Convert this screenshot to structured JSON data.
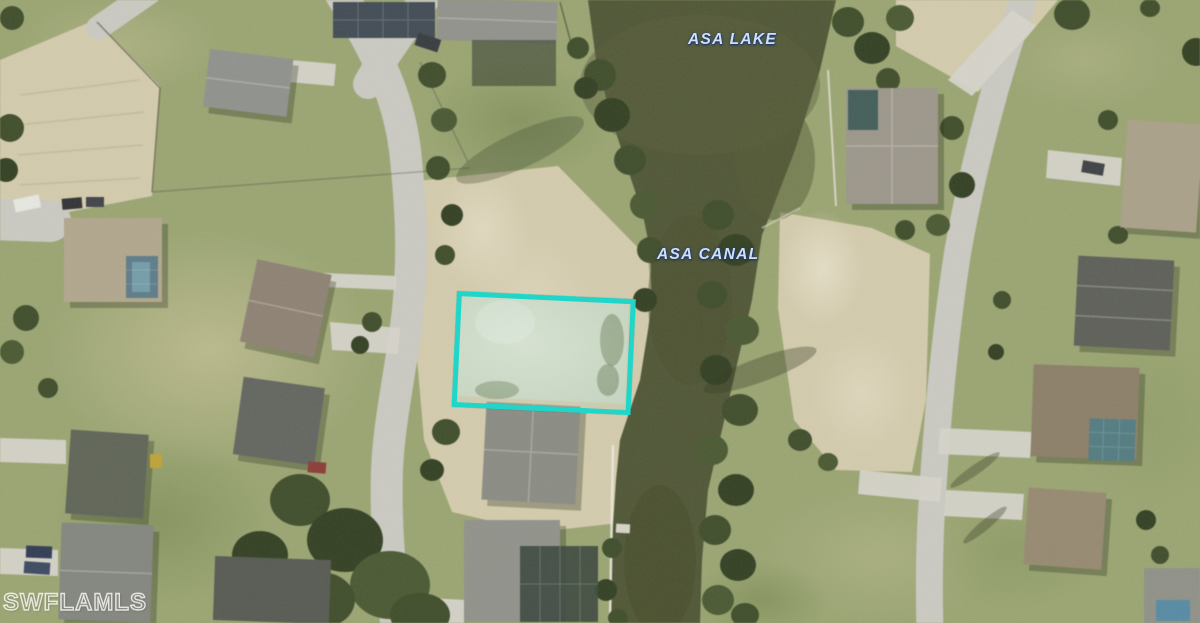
{
  "map": {
    "type": "aerial-satellite-photo",
    "labels": [
      {
        "id": "lake",
        "text": "ASA LAKE"
      },
      {
        "id": "canal",
        "text": "ASA CANAL"
      }
    ],
    "watermark": {
      "text": "SWFLAMLS"
    },
    "highlight": {
      "description": "listed vacant lot outline",
      "color": "#1fd6c9"
    },
    "colors": {
      "water": "#4c5330",
      "grass": "#99a46d",
      "sand": "#d5ccab",
      "road": "#cbcac2",
      "tree": "#3b4a25",
      "label_text": "#cfe0fa"
    }
  }
}
